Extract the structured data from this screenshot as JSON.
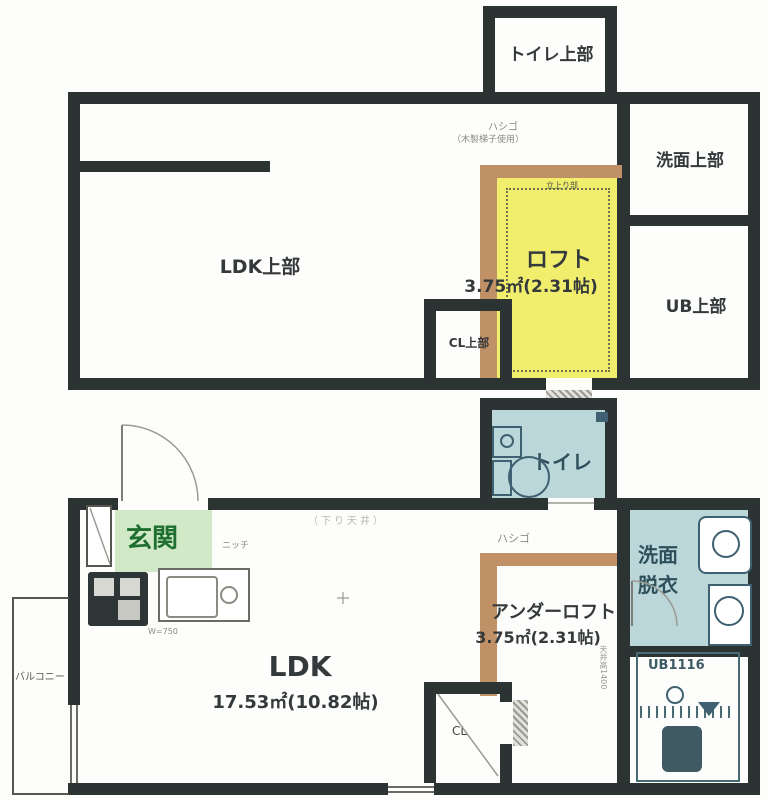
{
  "colors": {
    "wall": "#2c3433",
    "loft_yellow": "#f1ee6d",
    "ladder_tan": "#c09166",
    "entry_green": "#d2e9c8",
    "entry_text": "#1f7030",
    "room_blue": "#bcd7d9",
    "fixture_blue": "#3e6070",
    "text_dark": "#34393b",
    "text_faint": "#8b8b83"
  },
  "upper_floor": {
    "toilet_upper": "トイレ上部",
    "ldk_upper": "LDK上部",
    "loft_name": "ロフト",
    "loft_area": "3.75㎡(2.31帖)",
    "ladder_label": "ハシゴ",
    "ladder_note": "（木製梯子使用）",
    "loft_note": "立上り部",
    "washroom_upper": "洗面上部",
    "ub_upper": "UB上部",
    "closet_upper": "CL上部"
  },
  "lower_floor": {
    "toilet": "トイレ",
    "entry": "玄関",
    "niche": "ニッチ",
    "kitchen_note": "W=750",
    "ceiling_note": "（下り天井）",
    "ldk_name": "LDK",
    "ldk_area": "17.53㎡(10.82帖)",
    "ladder_label": "ハシゴ",
    "underloft_name": "アンダーロフト",
    "underloft_area": "3.75㎡(2.31帖)",
    "underloft_note": "天井高1400",
    "washroom_line1": "洗面",
    "washroom_line2": "脱衣",
    "ub": "UB1116",
    "closet": "CL",
    "balcony": "バルコニー"
  }
}
